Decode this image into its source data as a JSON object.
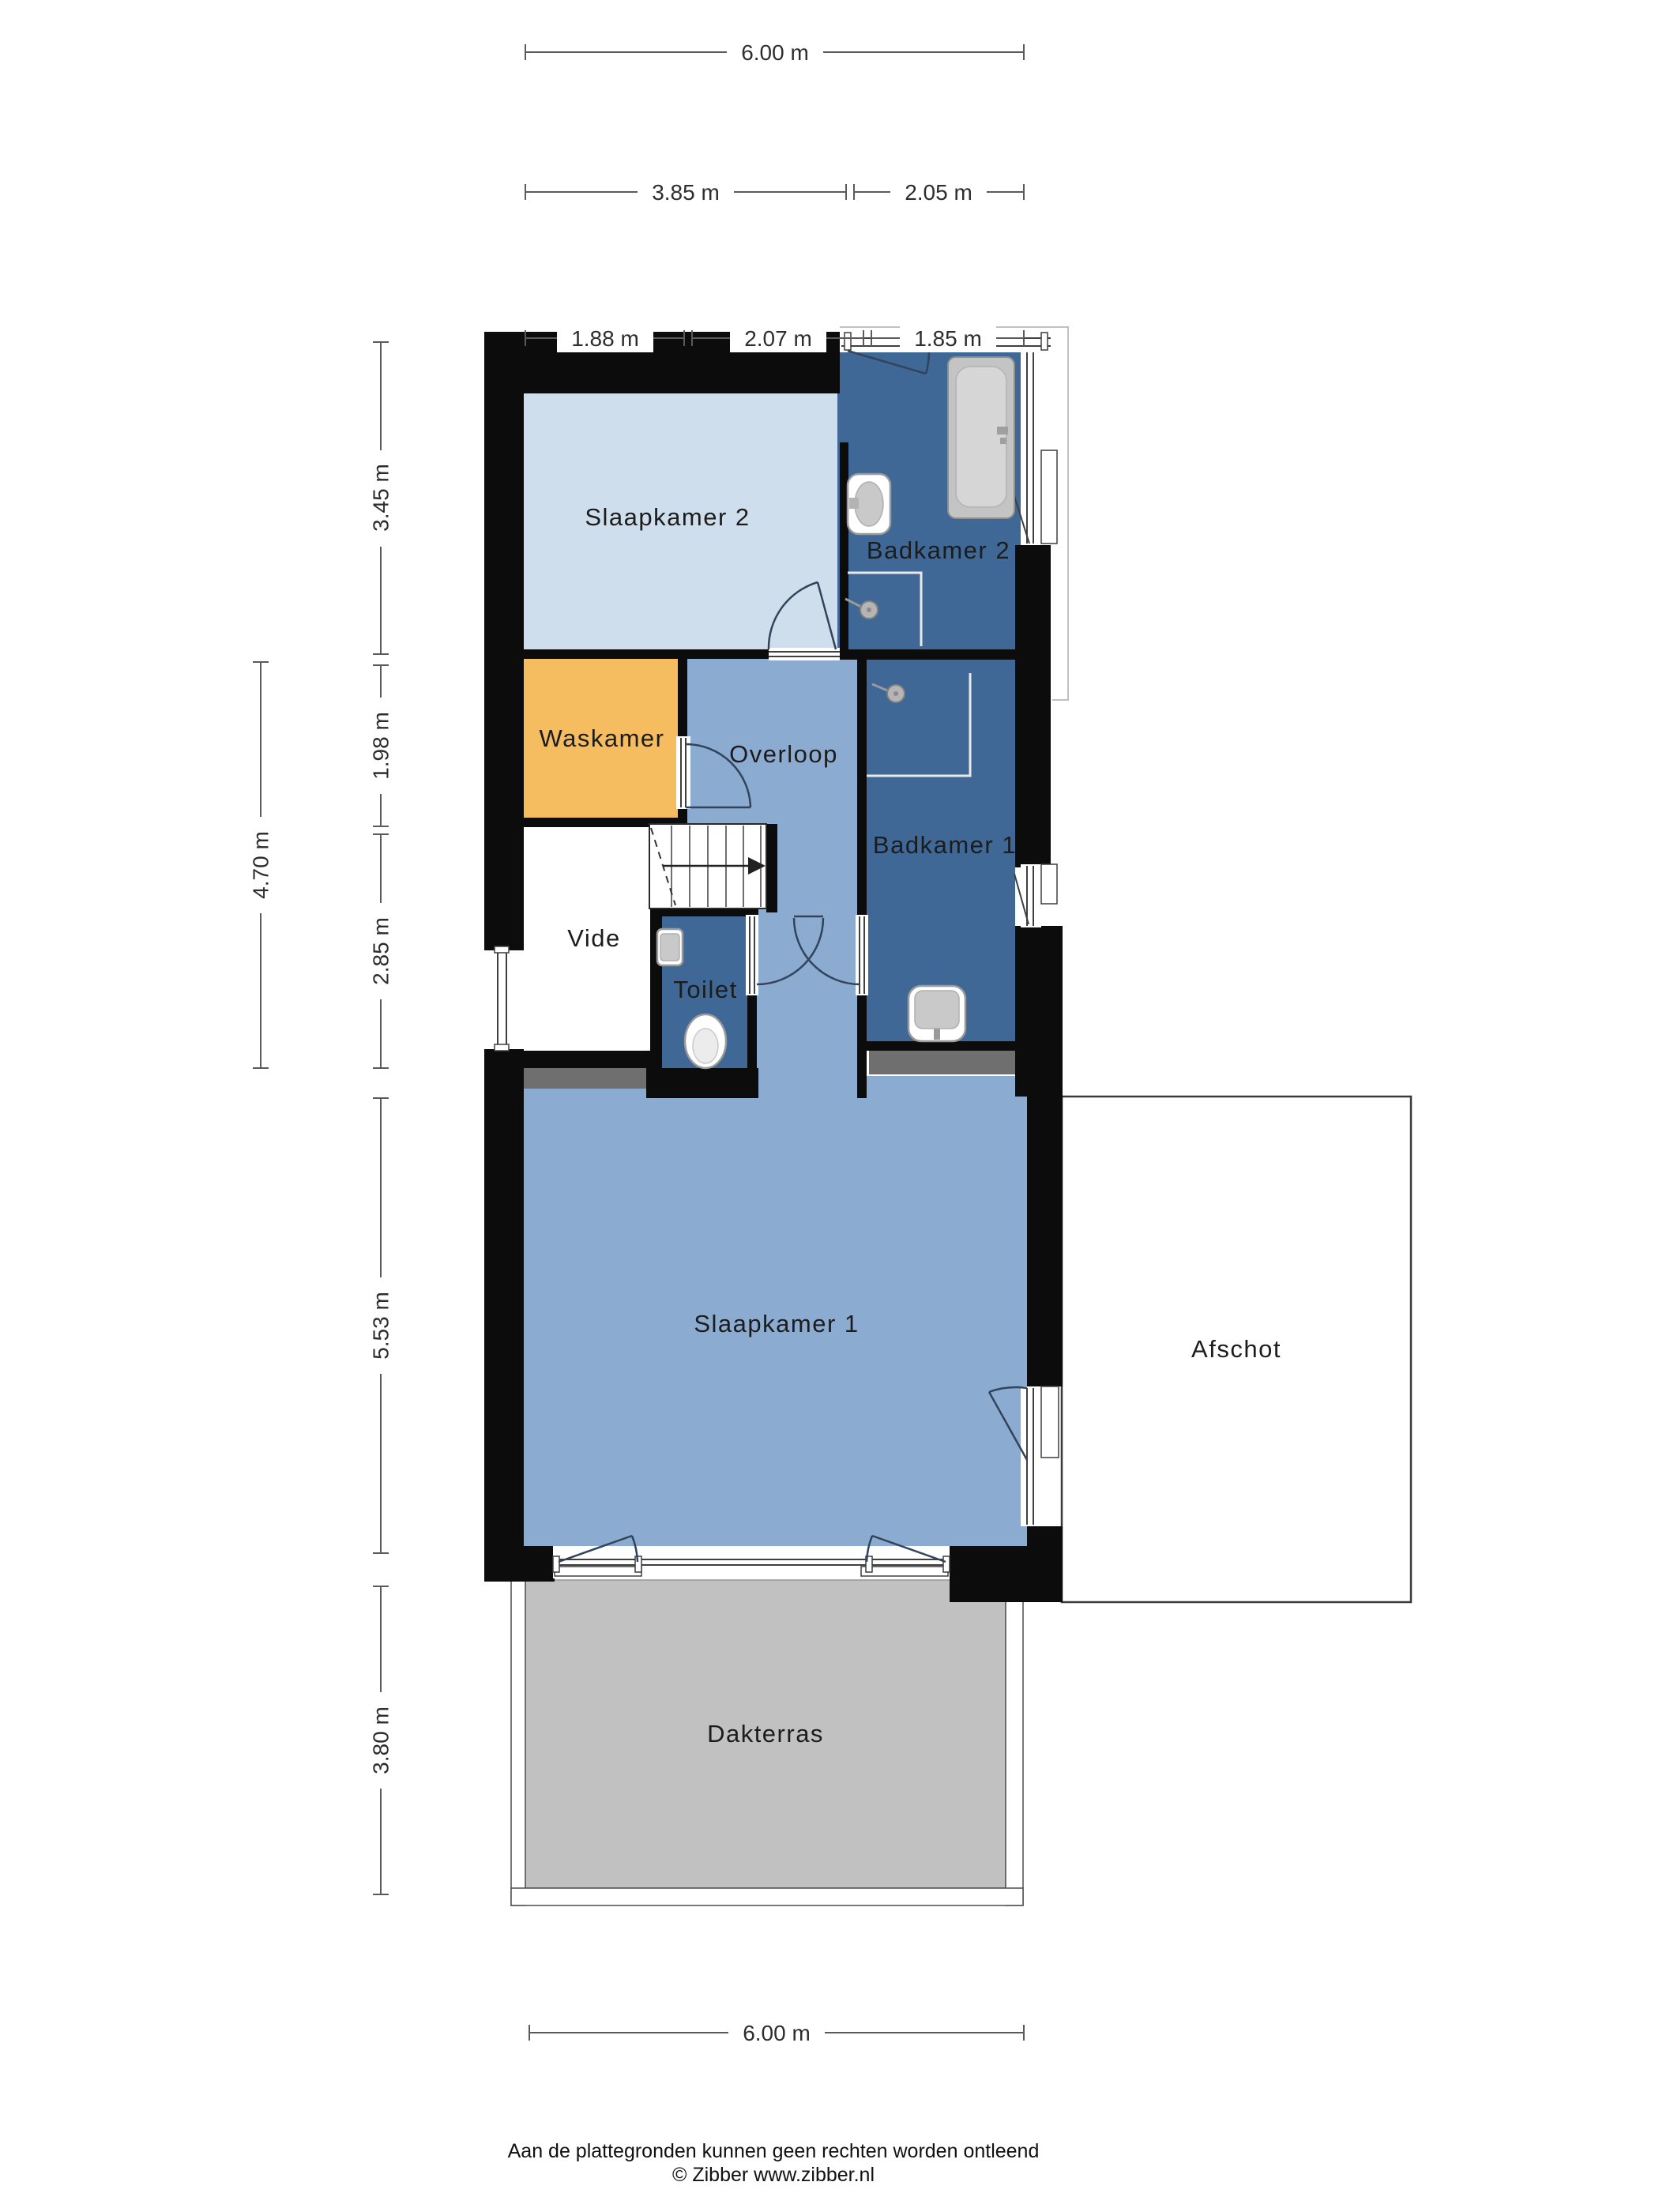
{
  "page": {
    "title": "Floor plan - verdieping",
    "footer_line1": "Aan de plattegronden kunnen geen rechten worden ontleend",
    "footer_line2": "© Zibber www.zibber.nl"
  },
  "palette": {
    "wall": "#0c0c0c",
    "room_light_blue": "#cedeed",
    "room_mid_blue": "#8cabd1",
    "room_dark_blue": "#3f6896",
    "room_orange": "#f6bc60",
    "terrace_gray": "#c1c1c1",
    "knee_wall_gray": "#6f6f6f",
    "vide_white": "#ffffff",
    "afschot_white": "#ffffff",
    "dim_line": "#5a5a5a",
    "label_text": "#1c1c1c"
  },
  "rooms": {
    "slaapkamer2": {
      "label": "Slaapkamer 2"
    },
    "badkamer2": {
      "label": "Badkamer 2"
    },
    "waskamer": {
      "label": "Waskamer"
    },
    "overloop": {
      "label": "Overloop"
    },
    "badkamer1": {
      "label": "Badkamer 1"
    },
    "vide": {
      "label": "Vide"
    },
    "toilet": {
      "label": "Toilet"
    },
    "slaapkamer1": {
      "label": "Slaapkamer 1"
    },
    "afschot": {
      "label": "Afschot"
    },
    "dakterras": {
      "label": "Dakterras"
    }
  },
  "dimensions": {
    "top_total": "6.00 m",
    "top_seg_left": "3.85 m",
    "top_seg_right": "2.05 m",
    "top_w1": "1.88 m",
    "top_w2": "2.07 m",
    "top_w3": "1.85 m",
    "left_sk2": "3.45 m",
    "left_waskamer": "1.98 m",
    "left_vide": "2.85 m",
    "left_mid_total": "4.70 m",
    "left_sk1": "5.53 m",
    "left_terras": "3.80 m",
    "bottom_total": "6.00 m"
  }
}
